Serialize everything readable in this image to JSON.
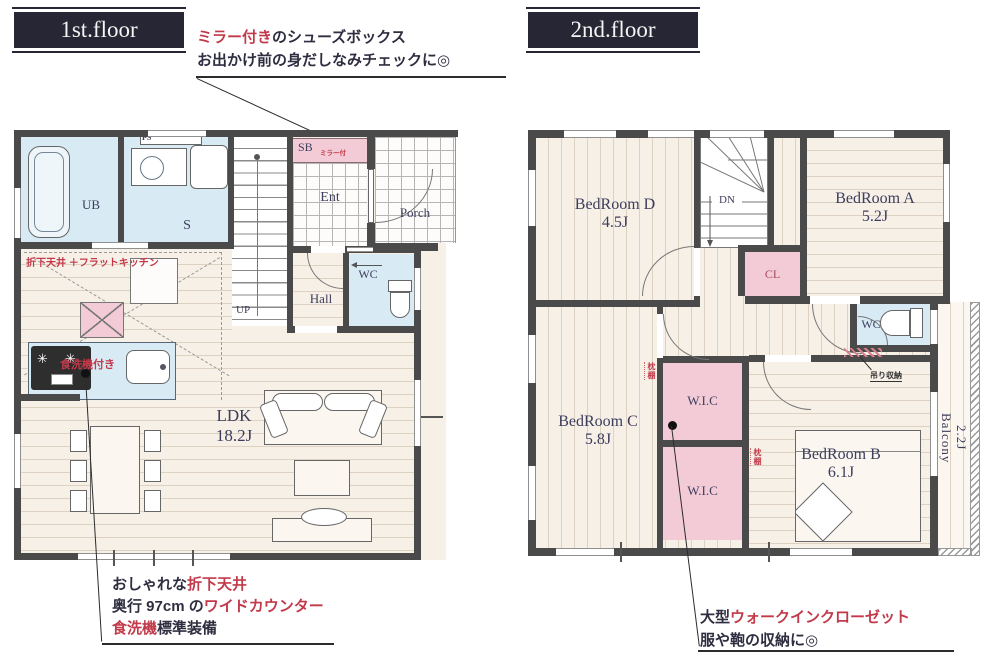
{
  "colors": {
    "wall": "#4a4a4a",
    "accent_red": "#c23a4a",
    "title_navy": "#262634",
    "label_navy": "#3d3d5c",
    "wet_area_blue": "#d8eaf4",
    "closet_pink": "#f3cbd7",
    "floor_cream": "#f6f0e7"
  },
  "titles": {
    "floor1": "1st.floor",
    "floor2": "2nd.floor"
  },
  "annotations": {
    "shoebox": {
      "lead_red": "ミラー付き",
      "lead_rest": "のシューズボックス",
      "line2": "お出かけ前の身だしなみチェックに◎"
    },
    "kitchen": {
      "l1_dark": "おしゃれな",
      "l1_red": "折下天井",
      "l2_dark": "奥行 97cm の",
      "l2_red": "ワイドカウンター",
      "l3_red": "食洗機",
      "l3_dark": "標準装備"
    },
    "wic": {
      "l1_dark": "大型",
      "l1_red": "ウォークインクローゼット",
      "line2": "服や鞄の収納に◎"
    }
  },
  "floor1": {
    "ub": "UB",
    "s": "S",
    "ps": "PS",
    "sb": "SB",
    "sb_note": "ミラー付",
    "ent": "Ent",
    "porch": "Porch",
    "hall": "Hall",
    "wc": "WC",
    "up": "UP",
    "ldk": "LDK",
    "ldk_size": "18.2J",
    "ceiling_note": "折下天井 ＋フラットキッチン",
    "dishwasher_note": "食洗機付き"
  },
  "floor2": {
    "bedroom_d": "BedRoom D",
    "bedroom_d_size": "4.5J",
    "bedroom_a": "BedRoom A",
    "bedroom_a_size": "5.2J",
    "bedroom_c": "BedRoom C",
    "bedroom_c_size": "5.8J",
    "bedroom_b": "BedRoom B",
    "bedroom_b_size": "6.1J",
    "balcony": "Balcony",
    "balcony_size": "2.2J",
    "cl": "CL",
    "wc": "WC",
    "wic_upper": "W.I.C",
    "wic_lower": "W.I.C",
    "dn": "DN",
    "shelf_upper": "枕棚",
    "shelf_lower": "枕棚",
    "storage_note": "吊り収納"
  },
  "icons": {
    "burner": "✳"
  }
}
